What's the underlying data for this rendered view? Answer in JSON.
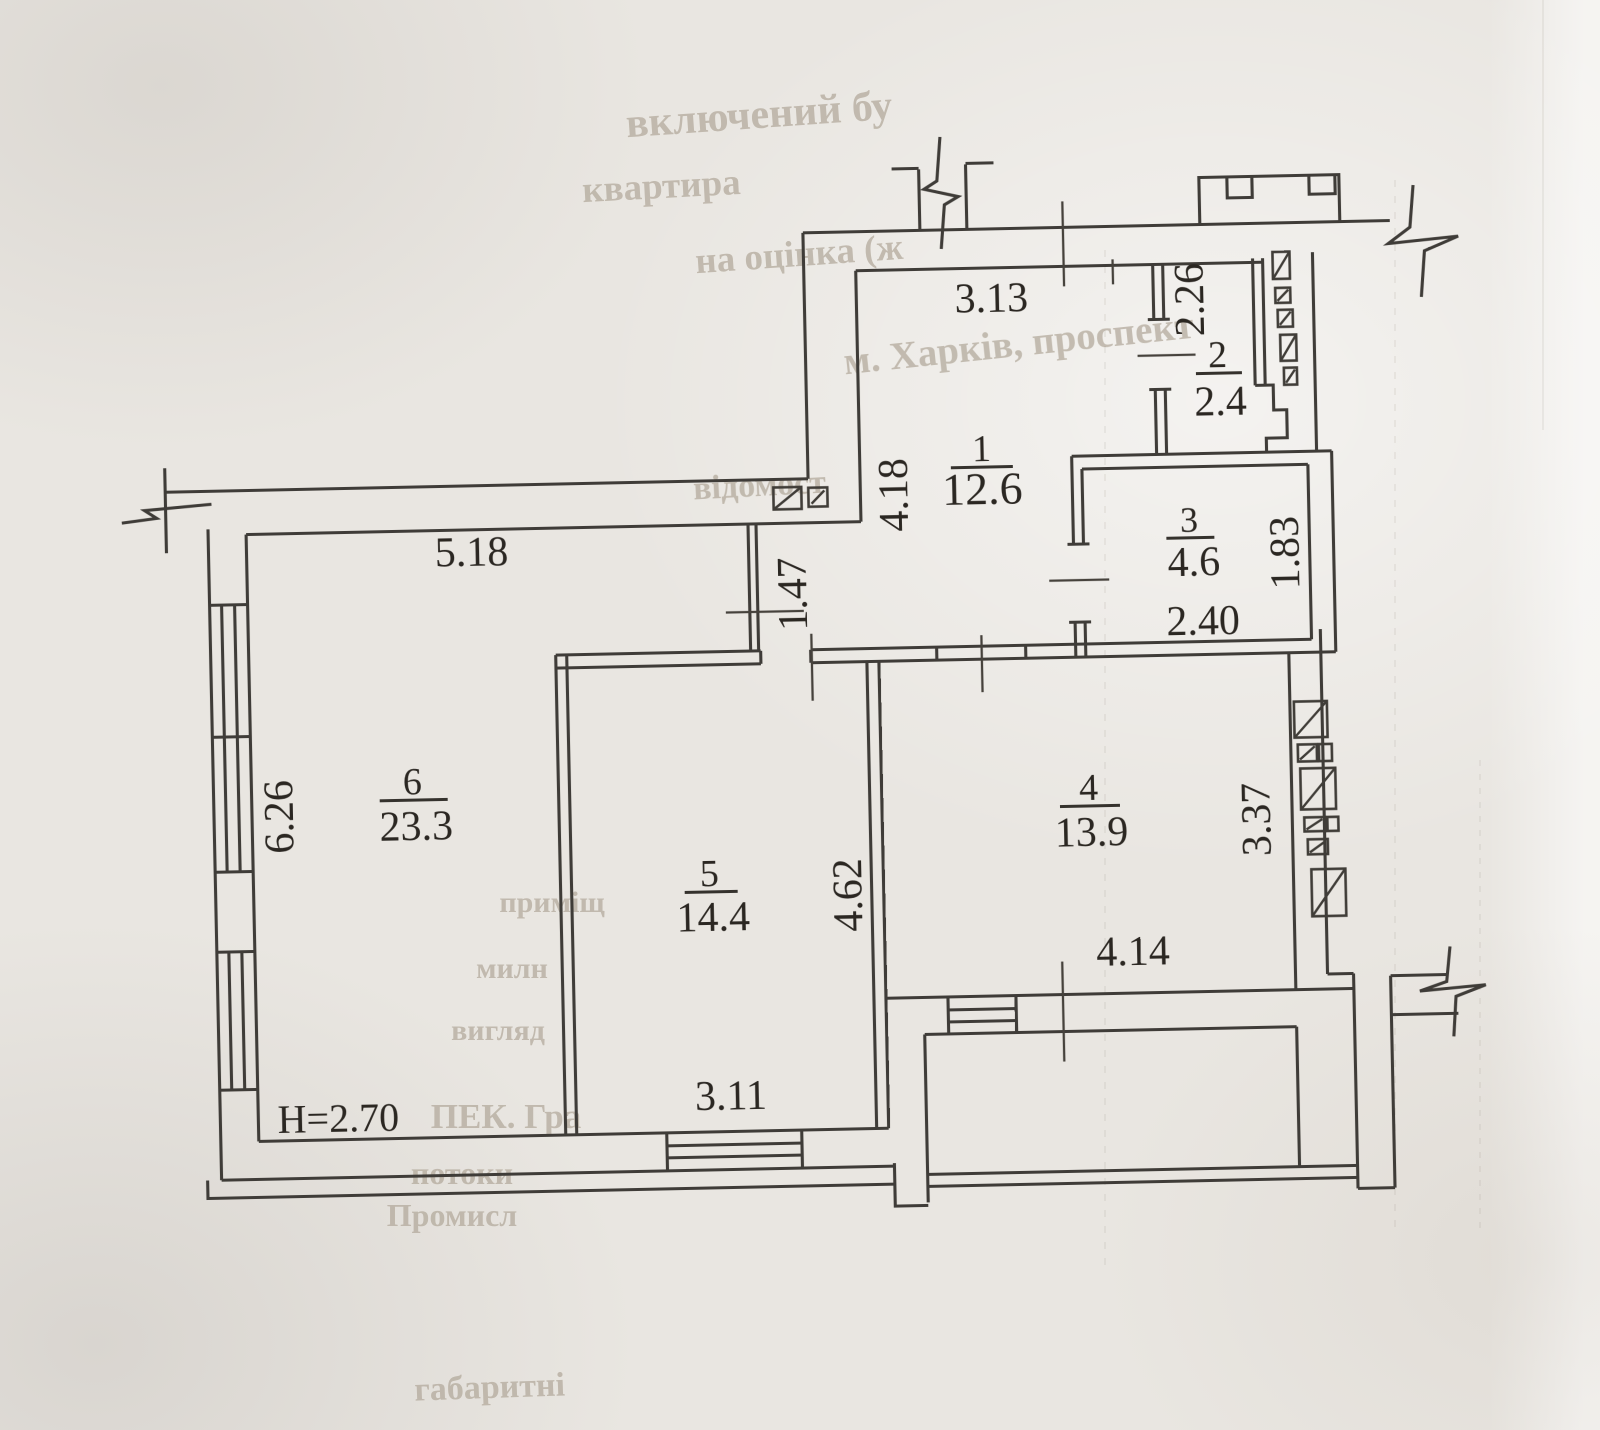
{
  "plan": {
    "ceiling_height": "H=2.70",
    "rooms": [
      {
        "number": "1",
        "area": "12.6"
      },
      {
        "number": "2",
        "area": "2.4"
      },
      {
        "number": "3",
        "area": "4.6"
      },
      {
        "number": "4",
        "area": "13.9"
      },
      {
        "number": "5",
        "area": "14.4"
      },
      {
        "number": "6",
        "area": "23.3"
      }
    ],
    "dimensions": {
      "d_3_13": "3.13",
      "d_2_26": "2.26",
      "d_4_18": "4.18",
      "d_1_47": "1.47",
      "d_5_18": "5.18",
      "d_6_26": "6.26",
      "d_2_40": "2.40",
      "d_1_83": "1.83",
      "d_4_62": "4.62",
      "d_3_37": "3.37",
      "d_4_14": "4.14",
      "d_3_11": "3.11"
    },
    "bleed_fragments": [
      {
        "text": "включений бу"
      },
      {
        "text": "квартира"
      },
      {
        "text": "на оцінка (ж"
      },
      {
        "text": "м. Харків, проспект"
      },
      {
        "text": "відомост"
      },
      {
        "text": "приміщ"
      },
      {
        "text": "милн"
      },
      {
        "text": "вигляд"
      },
      {
        "text": "ПЕК. Гра"
      },
      {
        "text": "потоки"
      },
      {
        "text": "Промисл"
      },
      {
        "text": "габаритні"
      }
    ]
  }
}
